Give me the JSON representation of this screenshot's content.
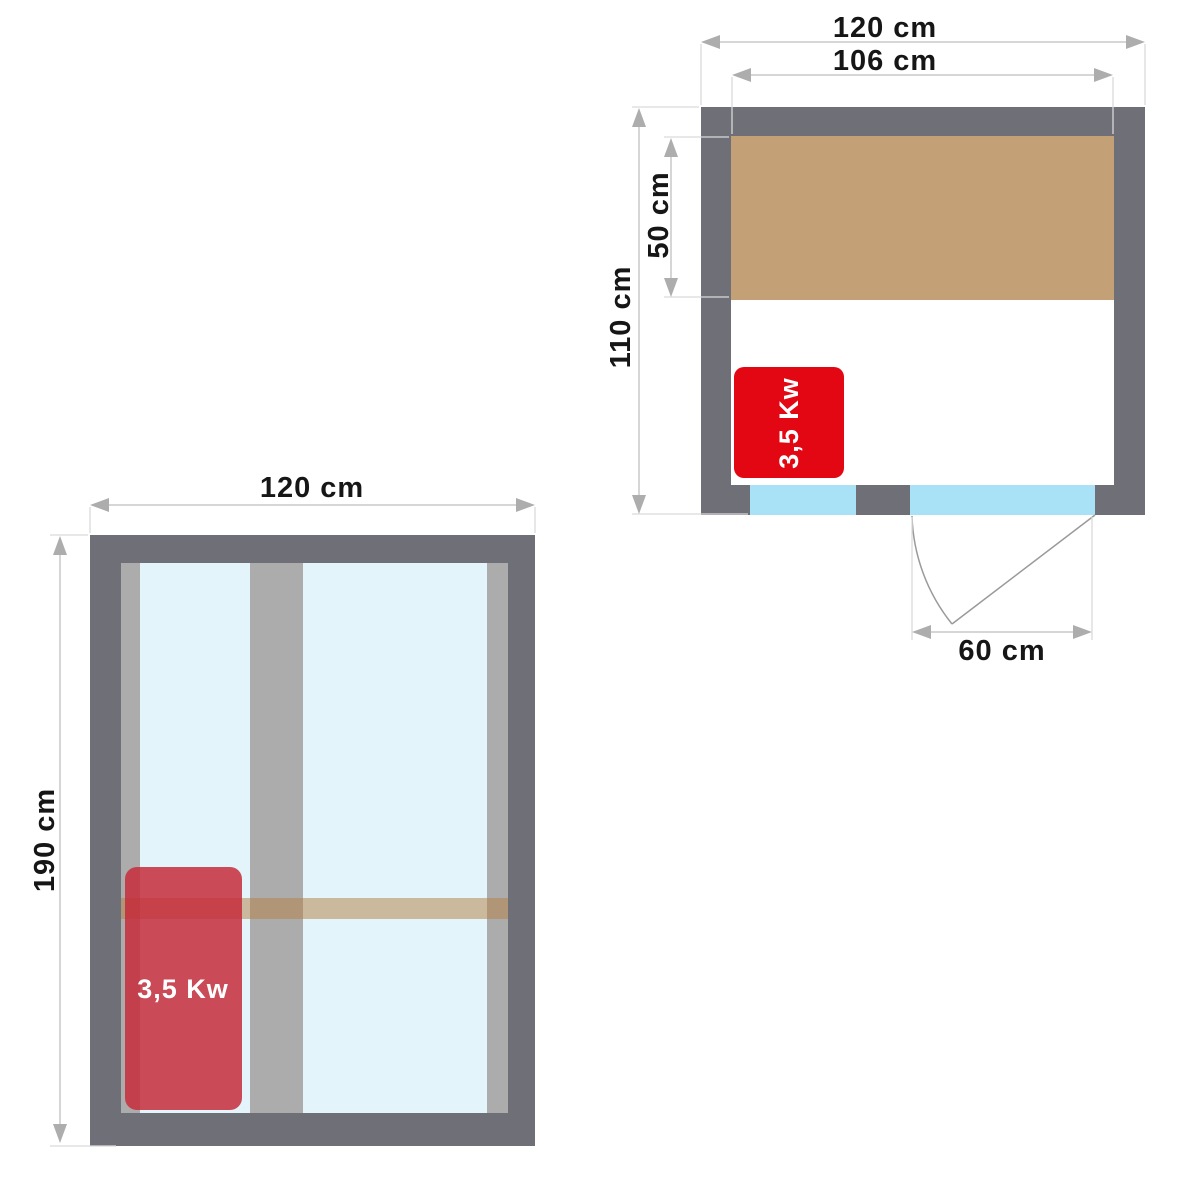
{
  "palette": {
    "wall": "#6F6F78",
    "mullion": "#ACACAC",
    "bench": "#C3A075",
    "bench_bar": "rgba(180,125,65,0.5)",
    "glass_plan": "#A9E2F6",
    "glass_elevation": "#E3F4FB",
    "heater_plan": "#E30613",
    "heater_elevation": "rgba(198,44,57,0.85)",
    "heater_text": "#FFFFFF",
    "text": "#161616",
    "dim_line": "#C9C9C9",
    "ext_line": "#DADADA",
    "arrow": "#ADADAD",
    "door_line": "#9A9A9A",
    "background": "#FFFFFF"
  },
  "plan": {
    "dims": {
      "outer_width": "120 cm",
      "inner_width": "106 cm",
      "depth": "110 cm",
      "bench_depth": "50 cm",
      "door_width": "60 cm"
    },
    "heater_label": "3,5 Kw"
  },
  "elevation": {
    "dims": {
      "width": "120 cm",
      "height": "190 cm"
    },
    "heater_label": "3,5 Kw"
  }
}
